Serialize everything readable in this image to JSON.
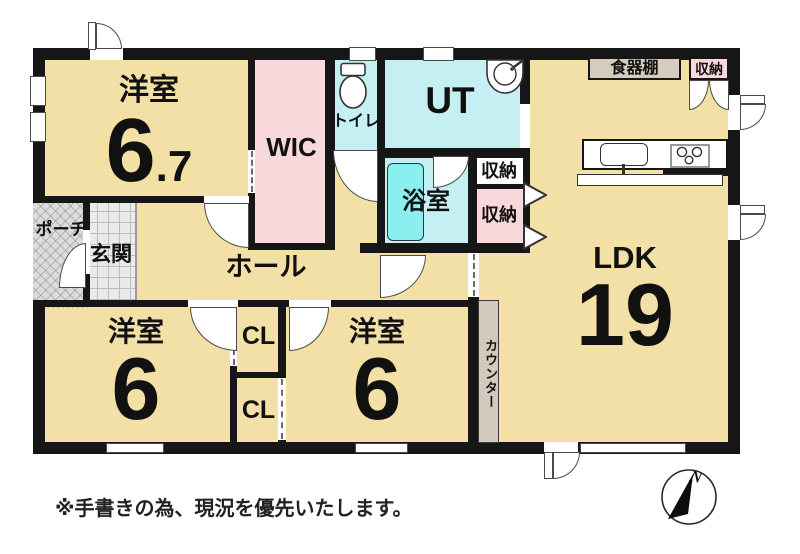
{
  "floorplan": {
    "rooms": {
      "bedroom_nw": {
        "label": "洋室",
        "size_whole": "6",
        "size_fraction": ".7"
      },
      "wic": {
        "label": "WIC"
      },
      "toilet": {
        "label": "トイレ"
      },
      "utility": {
        "label": "UT"
      },
      "bath": {
        "label": "浴室"
      },
      "storage_mid_upper": {
        "label": "収納"
      },
      "storage_mid_lower": {
        "label": "収納"
      },
      "cupboard": {
        "label": "食器棚"
      },
      "storage_ne": {
        "label": "収納"
      },
      "ldk": {
        "label": "LDK",
        "size": "19"
      },
      "hall": {
        "label": "ホール"
      },
      "entrance": {
        "label": "玄関"
      },
      "porch": {
        "label": "ポーチ"
      },
      "bedroom_sw": {
        "label": "洋室",
        "size": "6"
      },
      "closet_upper": {
        "label": "CL"
      },
      "closet_lower": {
        "label": "CL"
      },
      "bedroom_s": {
        "label": "洋室",
        "size": "6"
      },
      "counter": {
        "label": "カウンター"
      }
    },
    "annotations": {
      "note": "※手書きの為、現況を優先いたします。",
      "compass_north": "N"
    },
    "colors": {
      "floor": "#F2E0A6",
      "wet_area": "#C5EFF2",
      "bathtub": "#8BEFEF",
      "closet_pink": "#F9D8DC",
      "fixture_gray": "#D5CCBE",
      "wall": "#161616"
    }
  }
}
